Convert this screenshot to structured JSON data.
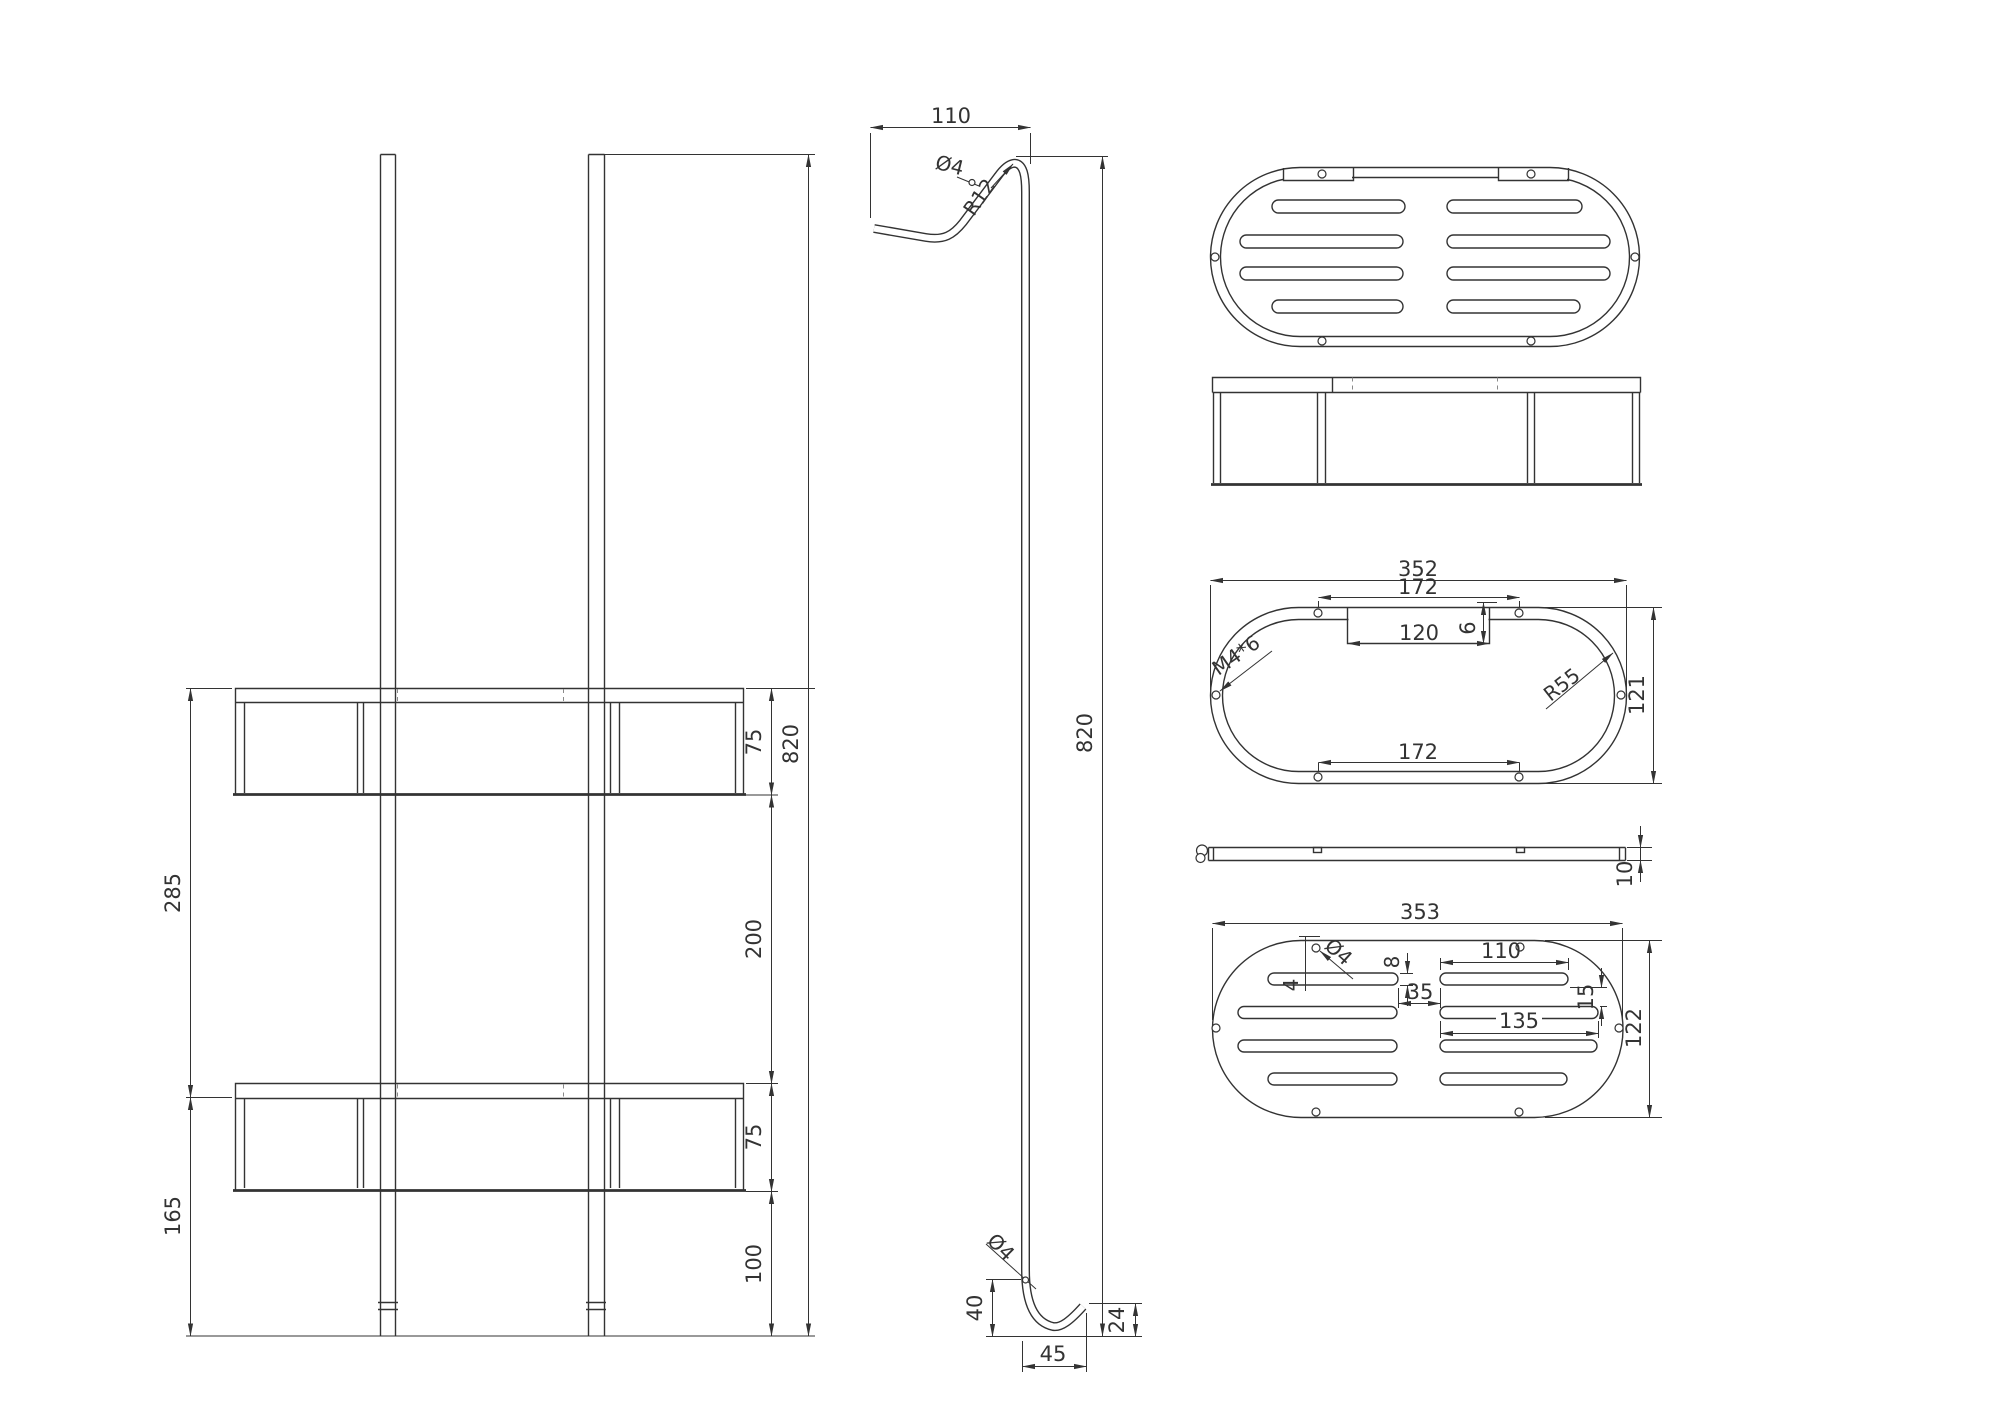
{
  "page": {
    "background": "#ffffff",
    "line_color": "#333333",
    "kind": "CAD technical drawing, shower caddy rack"
  },
  "views": {
    "front": {
      "dims": {
        "d285": "285",
        "d165": "165",
        "d75_top": "75",
        "d200": "200",
        "d75_bottom": "75",
        "d100": "100",
        "d820": "820"
      }
    },
    "profile": {
      "dims": {
        "d110": "110",
        "dia4_top": "Ø4",
        "r12": "R12",
        "d820": "820",
        "dia4_bottom": "Ø4",
        "d40": "40",
        "d45": "45",
        "d24": "24"
      }
    },
    "ring": {
      "dims": {
        "d352": "352",
        "d172_top": "172",
        "d120": "120",
        "d6": "6",
        "m4": "M4*6",
        "r55": "R55",
        "d121": "121",
        "d172_bottom": "172"
      }
    },
    "bar": {
      "dims": {
        "d10": "10"
      }
    },
    "plate": {
      "dims": {
        "d353": "353",
        "dia4": "Ø4",
        "d4": "4",
        "d8": "8",
        "d35": "35",
        "d110": "110",
        "d15": "15",
        "d135": "135",
        "d122": "122"
      }
    }
  }
}
